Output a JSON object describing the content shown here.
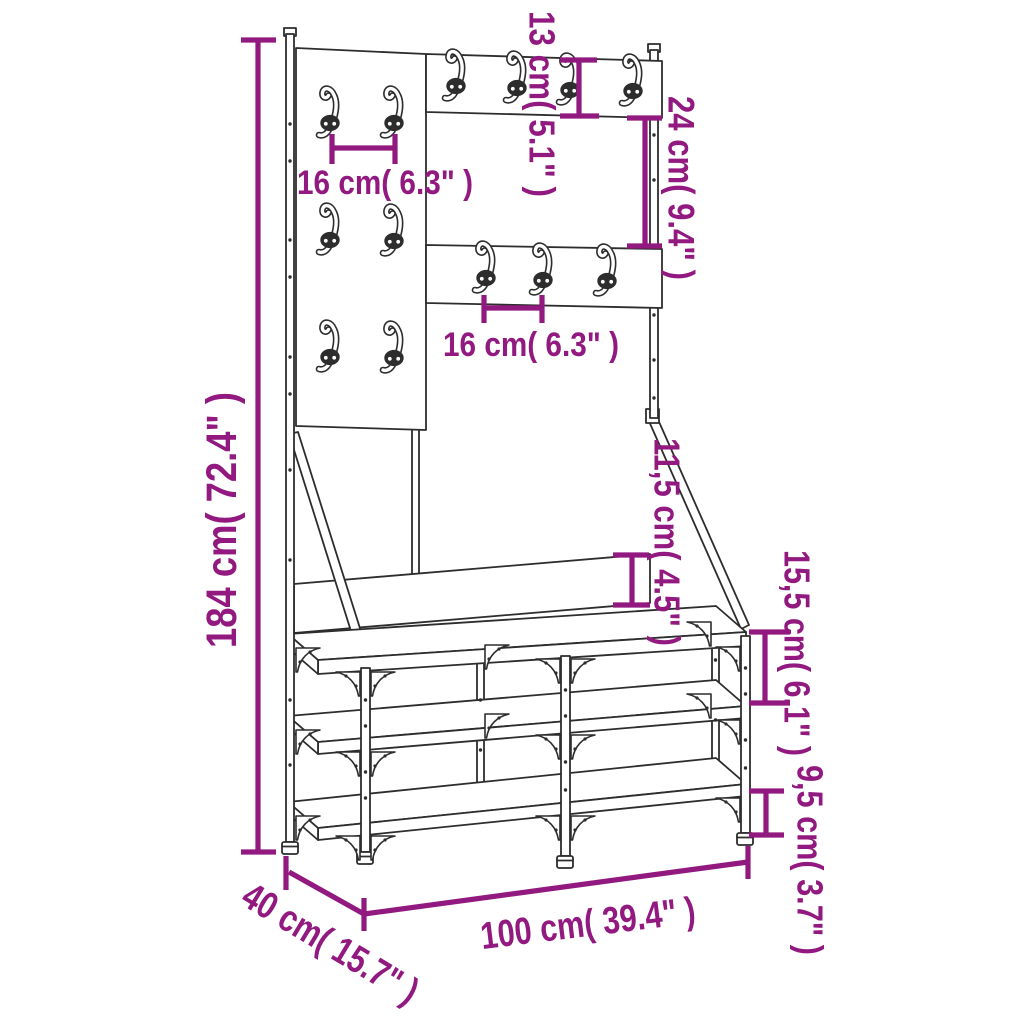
{
  "diagram": {
    "kind": "furniture-dimension-diagram",
    "subject": "clothes rack with shoe storage bench and coat hooks",
    "colors": {
      "dimension_accent": "#91197F",
      "drawing_line": "#2d2d2d",
      "background": "#ffffff"
    },
    "dimensions": {
      "total_height": "184 cm( 72.4\" )",
      "total_width": "100 cm( 39.4\" )",
      "total_depth": "40 cm( 15.7\" )",
      "hook_spacing_left_panel": "16 cm( 6.3\" )",
      "hook_spacing_middle_panel": "16 cm( 6.3\" )",
      "top_board_height": "13 cm( 5.1\" )",
      "gap_between_boards": "24 cm( 9.4\" )",
      "backrest_board_height": "11,5 cm( 4.5\" )",
      "seat_to_middle_shelf": "15,5 cm( 6.1\" )",
      "bottom_shelf_clearance": "9,5 cm( 3.7\" )"
    },
    "counts": {
      "hooks": 13,
      "shelves": 3
    }
  }
}
